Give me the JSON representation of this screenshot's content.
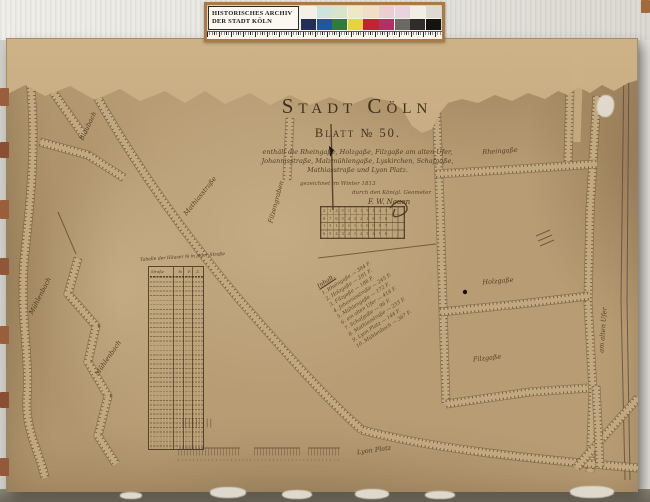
{
  "archive_card": {
    "title_line1": "HISTORISCHES ARCHIV",
    "title_line2": "DER STADT KÖLN",
    "color_patches_top": [
      "#f3f0e7",
      "#cfe3dd",
      "#d7e5c9",
      "#eee8c4",
      "#f0dfc6",
      "#eccdd1",
      "#e8d3de",
      "#f1eee6",
      "#dddad2"
    ],
    "color_patches_bottom": [
      "#252e55",
      "#2356a0",
      "#307a3b",
      "#e3d53c",
      "#c22531",
      "#b03068",
      "#6b6962",
      "#2e2d2b",
      "#141312"
    ]
  },
  "map": {
    "title": "Stadt Cöln",
    "sheet_label": "Blatt № 50.",
    "description_lines": [
      "enthält die Rheingaße, Holzgaße, Filzgaße am alten Ufer,",
      "Johannisstraße, Malzmühlengaße, Lyskirchen, Schafgaße,",
      "Mathiasstraße und Lyon Platz."
    ],
    "drawn_note": "gezeichnet im Winter 1813",
    "signature_line": "durch den Königl. Geometer",
    "signature_name": "F. W. Nauen",
    "street_labels": {
      "rheingasse": "Rheingaße",
      "holzgasse": "Holzgaße",
      "filzgasse": "Filzgaße",
      "am_alten_ufer": "am alten Ufer",
      "muehlenbach_1": "Mühlenbach",
      "muehlenbach_2": "Mühlenbach",
      "mathiasstrasse": "Mathiasstraße",
      "blaubach": "Blaubach",
      "filzengraben": "Filzengraben",
      "lyon_platz": "Lyon Platz"
    },
    "inhalt_list": {
      "header": "Inhalt.",
      "entries": [
        "1. Rheingaße — 384 F.",
        "2. Holzgaße — 291 F.",
        "3. Filzgaße — 186 F.",
        "4. Johannisstraße — 245 F.",
        "5. Mühlengaße — 172 F.",
        "6. am alten Ufer — 418 F.",
        "7. Schafgaße — 96 F.",
        "8. Mathiasstraße — 233 F.",
        "9. Lyon Platz — 144 F.",
        "10. Mühlenbach — 367 F."
      ]
    },
    "measure_table": {
      "caption": "Tabelle der Häuser № in jeder Straße",
      "headers": [
        "Straße",
        "№",
        "F.",
        "Z."
      ]
    },
    "lot_grid_rows": [
      "2 1 4 5 1 2 1 5 1 4 3",
      "8 7 6 5 4 3 2 1 8 7 6",
      "1 3 1 2 1 1 1 0 9 8 7",
      "6 5 4 3 2 1 2 3 4 5 6"
    ],
    "ink_color": "#4a3a26",
    "paper_color": "#b89d74"
  }
}
